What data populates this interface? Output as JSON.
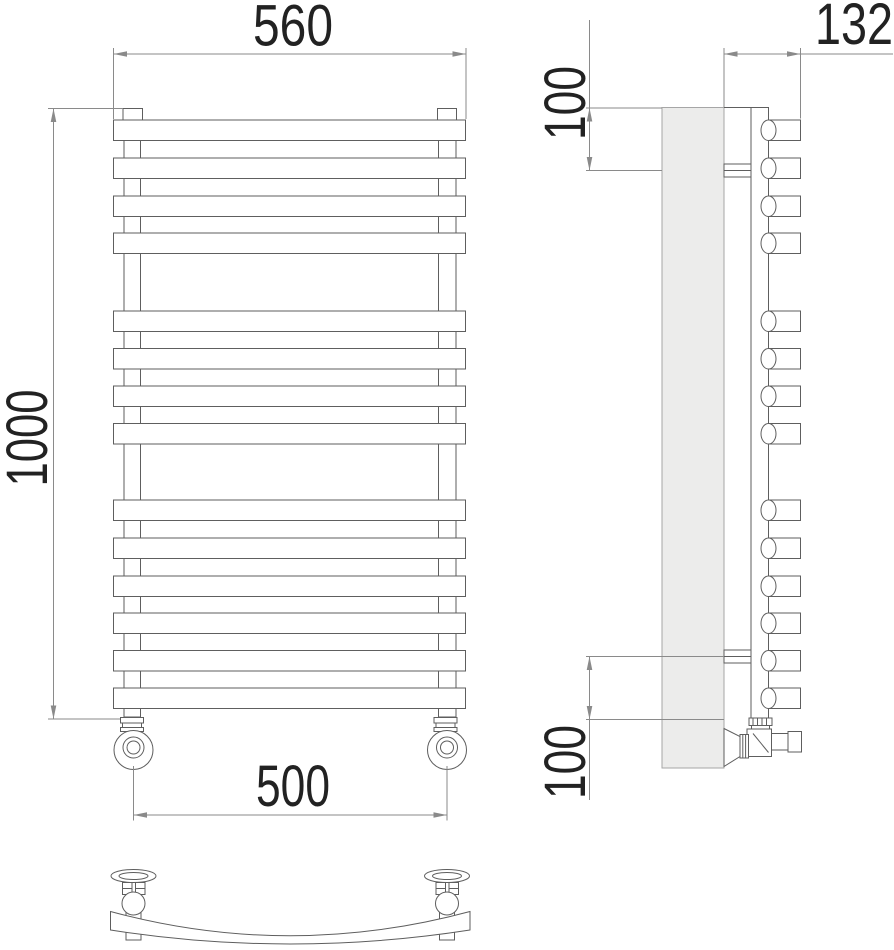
{
  "title": "towel-radiator-technical-drawing",
  "dimensions": {
    "width_top": "560",
    "height": "1000",
    "valve_spacing": "500",
    "depth": "132",
    "offset_top": "100",
    "offset_bottom": "100"
  },
  "geometry": {
    "bar_tops": [
      120,
      158,
      196,
      233,
      311,
      348.5,
      386,
      423.5,
      500,
      538,
      576,
      613,
      650.5,
      688
    ],
    "bar_height": 20.5,
    "bar_x": 113.5,
    "bar_width": 352,
    "tube_left_x": 124,
    "tube_right_x": 438.5,
    "side_tube_x": 768.5,
    "side_tube_width": 32
  },
  "colors": {
    "line": "#5e5e5e",
    "dim": "#8a8a8a",
    "text": "#222222",
    "wall_fill": "#ececeb",
    "wall_stroke": "#a6a6a6"
  }
}
